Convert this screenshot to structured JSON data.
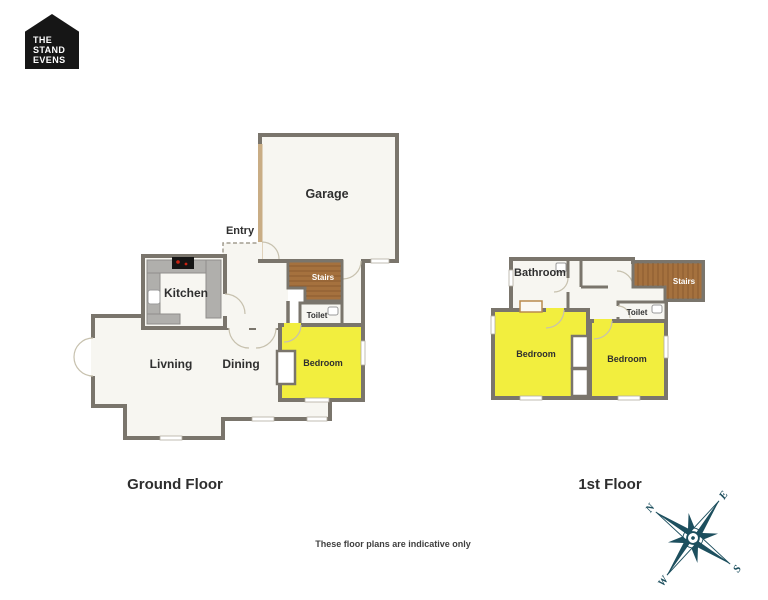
{
  "logo": {
    "line1": "THE",
    "line2": "STAND",
    "line3": "EVENS"
  },
  "ground_floor": {
    "title": "Ground Floor",
    "rooms": {
      "garage": "Garage",
      "entry": "Entry",
      "kitchen": "Kitchen",
      "stairs": "Stairs",
      "toilet": "Toilet",
      "bedroom": "Bedroom",
      "living": "Livning",
      "dining": "Dining"
    }
  },
  "first_floor": {
    "title": "1st Floor",
    "rooms": {
      "bathroom": "Bathroom",
      "stairs": "Stairs",
      "toilet": "Toilet",
      "bedroom_left": "Bedroom",
      "bedroom_right": "Bedroom"
    }
  },
  "compass": {
    "north": "N",
    "east": "E",
    "south": "S",
    "west": "W"
  },
  "disclaimer": "These floor plans are indicative only",
  "colors": {
    "wall": "#7a756c",
    "floor": "#f7f6f1",
    "room_highlight": "#f2ee3e",
    "stairs_brown": "#a5713e",
    "garage_wall_tan": "#c9ad85",
    "counter_gray": "#b0afac",
    "compass_teal": "#1d4f5e",
    "logo_black": "#161616"
  }
}
